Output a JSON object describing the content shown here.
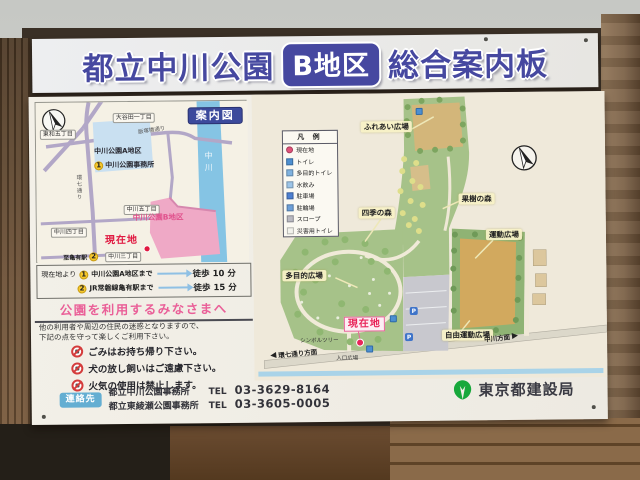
{
  "title_board": {
    "park_name": "都立中川公園",
    "district_badge": "B地区",
    "board_type": "総合案内板"
  },
  "inset_map": {
    "badge": "案内図",
    "streets": {
      "otaniata": "大谷田一丁目",
      "towa": "東和五丁目",
      "nakagawa5": "中川五丁目",
      "nakagawa4": "中川四丁目",
      "nakagawa3": "中川三丁目"
    },
    "roads": {
      "iizukabashi": "飯塚橋通り",
      "kannana": "環七通り"
    },
    "river": "中川",
    "area_a": "中川公園A地区",
    "office": {
      "num": "1",
      "label": "中川公園事務所"
    },
    "area_b": "中川公園B地区",
    "current_location": "現在地",
    "station": {
      "label": "至亀有駅",
      "num": "2"
    }
  },
  "route_info": {
    "from": "現在地より",
    "routes": [
      {
        "num": "1",
        "dest": "中川公園A地区まで",
        "time": "徒歩 10 分"
      },
      {
        "num": "2",
        "dest": "JR常磐線亀有駅まで",
        "time": "徒歩 15 分"
      }
    ]
  },
  "notice": {
    "title": "公園を利用するみなさまへ",
    "intro_line1": "他の利用者や周辺の住民の迷惑となりますので、",
    "intro_line2": "下記の点を守って楽しくご利用下さい。",
    "rules": [
      {
        "icon": "no-litter",
        "text": "ごみはお持ち帰り下さい。"
      },
      {
        "icon": "no-dog-offleash",
        "text": "犬の放し飼いはご遠慮下さい。"
      },
      {
        "icon": "no-fire",
        "text": "火気の使用は禁止します。"
      }
    ]
  },
  "contact": {
    "badge": "連絡先",
    "offices": [
      {
        "name": "都立中川公園事務所",
        "tel_label": "TEL",
        "tel": "03-3629-8164"
      },
      {
        "name": "都立東綾瀬公園事務所",
        "tel_label": "TEL",
        "tel": "03-3605-0005"
      }
    ]
  },
  "agency": "東京都建設局",
  "park_map": {
    "legend": {
      "title": "凡 例",
      "items": [
        {
          "label": "現在地",
          "icon": "current-location-dot",
          "color": "#e0527a"
        },
        {
          "label": "トイレ",
          "icon": "toilet",
          "color": "#4d8fd1"
        },
        {
          "label": "多目的トイレ",
          "icon": "accessible-toilet",
          "color": "#7fb2e0"
        },
        {
          "label": "水飲み",
          "icon": "drinking-fountain",
          "color": "#9cc4e8"
        },
        {
          "label": "駐車場",
          "icon": "parking",
          "color": "#4d7fd1"
        },
        {
          "label": "駐輪場",
          "icon": "bicycle-parking",
          "color": "#6d9fd8"
        },
        {
          "label": "スロープ",
          "icon": "slope",
          "color": "#b9b9c2"
        },
        {
          "label": "災害用トイレ",
          "icon": "disaster-toilet",
          "color": "#f2f2ec"
        }
      ]
    },
    "areas": {
      "fureai": "ふれあい広場",
      "shiki": "四季の森",
      "kaju": "果樹の森",
      "undo": "運動広場",
      "tamokuteki": "多目的広場",
      "jiyu": "自由運動広場"
    },
    "current_location": "現在地",
    "directions": {
      "west": "環七通り方面",
      "east": "中川方面"
    },
    "small_labels": {
      "symbol_tree": "シンボルツリー",
      "entrance": "入口広場"
    }
  }
}
